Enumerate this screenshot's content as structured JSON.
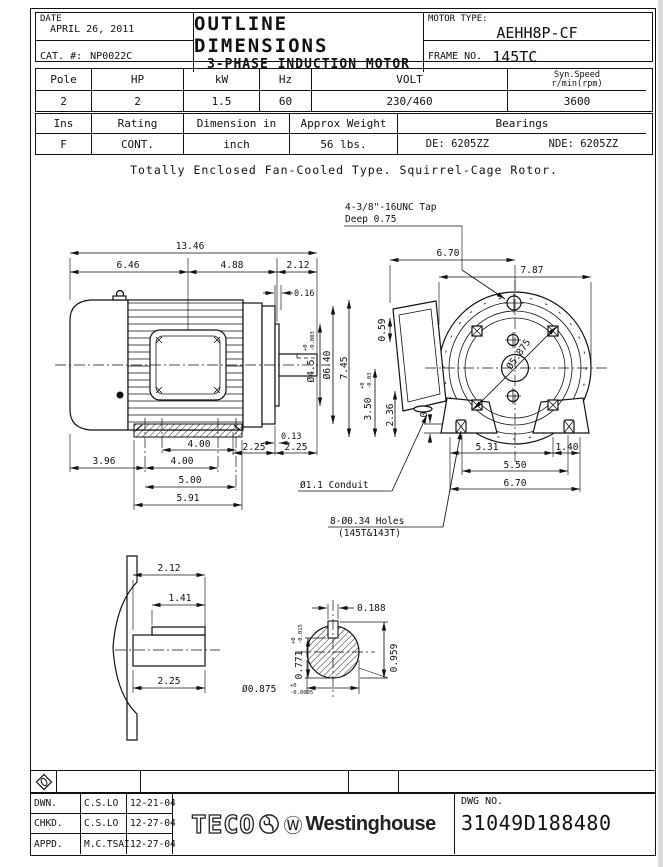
{
  "header": {
    "date_label": "DATE",
    "date_value": "APRIL 26, 2011",
    "cat_label": "CAT. #:",
    "cat_value": "NP0022C",
    "title_line1": "OUTLINE DIMENSIONS",
    "title_line2": "3-PHASE INDUCTION MOTOR",
    "motor_type_label": "MOTOR TYPE:",
    "motor_type_value": "AEHH8P-CF",
    "frame_label": "FRAME NO.",
    "frame_value": "145TC"
  },
  "spec_table1": {
    "h_pole": "Pole",
    "h_hp": "HP",
    "h_kw": "kW",
    "h_hz": "Hz",
    "h_volt": "VOLT",
    "h_speed1": "Syn.Speed",
    "h_speed2": "r/min(rpm)",
    "v_pole": "2",
    "v_hp": "2",
    "v_kw": "1.5",
    "v_hz": "60",
    "v_volt": "230/460",
    "v_speed": "3600"
  },
  "spec_table2": {
    "h_ins": "Ins",
    "h_rating": "Rating",
    "h_dim": "Dimension in",
    "h_weight": "Approx Weight",
    "h_bearings": "Bearings",
    "v_ins": "F",
    "v_rating": "CONT.",
    "v_dim": "inch",
    "v_weight": "56 lbs.",
    "v_de": "DE: 6205ZZ",
    "v_nde": "NDE: 6205ZZ"
  },
  "note": "Totally Enclosed Fan-Cooled Type. Squirrel-Cage Rotor.",
  "drawing": {
    "ann": {
      "tap1": "4-3/8\"-16UNC Tap",
      "tap2": "Deep 0.75",
      "conduit": "Ø1.1 Conduit",
      "holes1": "8-Ø0.34 Holes",
      "holes2": "(145T&143T)"
    },
    "dims": {
      "d_1346": "13.46",
      "d_646": "6.46",
      "d_488": "4.88",
      "d_212": "2.12",
      "d_016": "0.16",
      "d_dia45": "Ø4.5",
      "tol45_hi": "+0",
      "tol45_lo": "-0.003",
      "d_dia640": "Ø6.40",
      "d_745": "7.45",
      "d_059": "0.59",
      "d_350": "3.50",
      "tol350_hi": "+0",
      "tol350_lo": "-0.03",
      "d_236": "2.36",
      "d_035": "0.35",
      "d_013": "0.13",
      "d_225a": "2.25",
      "d_225b": "2.25",
      "d_400a": "4.00",
      "d_400b": "4.00",
      "d_500": "5.00",
      "d_591": "5.91",
      "d_396": "3.96",
      "d_670t": "6.70",
      "d_787": "7.87",
      "d_531": "5.31",
      "d_140": "1.40",
      "d_550": "5.50",
      "d_670b": "6.70",
      "d_5875": "Ø5.875",
      "d_212k": "2.12",
      "d_141": "1.41",
      "d_225k": "2.25",
      "d_0188": "0.188",
      "d_0771": "0.771",
      "tol771_hi": "+0",
      "tol771_lo": "-0.015",
      "d_0875": "Ø0.875",
      "tol875_hi": "+0",
      "tol875_lo": "-0.0005",
      "d_0959": "0.959"
    }
  },
  "title_block": {
    "rows": [
      {
        "role": "DWN.",
        "name": "C.S.LO",
        "date": "12-21-04"
      },
      {
        "role": "CHKD.",
        "name": "C.S.LO",
        "date": "12-27-04"
      },
      {
        "role": "APPD.",
        "name": "M.C.TSAI",
        "date": "12-27-04"
      }
    ],
    "teco": "TECO",
    "w_circle": "Ⓦ",
    "westinghouse": "Westinghouse",
    "dwg_label": "DWG NO.",
    "dwg_no": "31049D188480"
  }
}
